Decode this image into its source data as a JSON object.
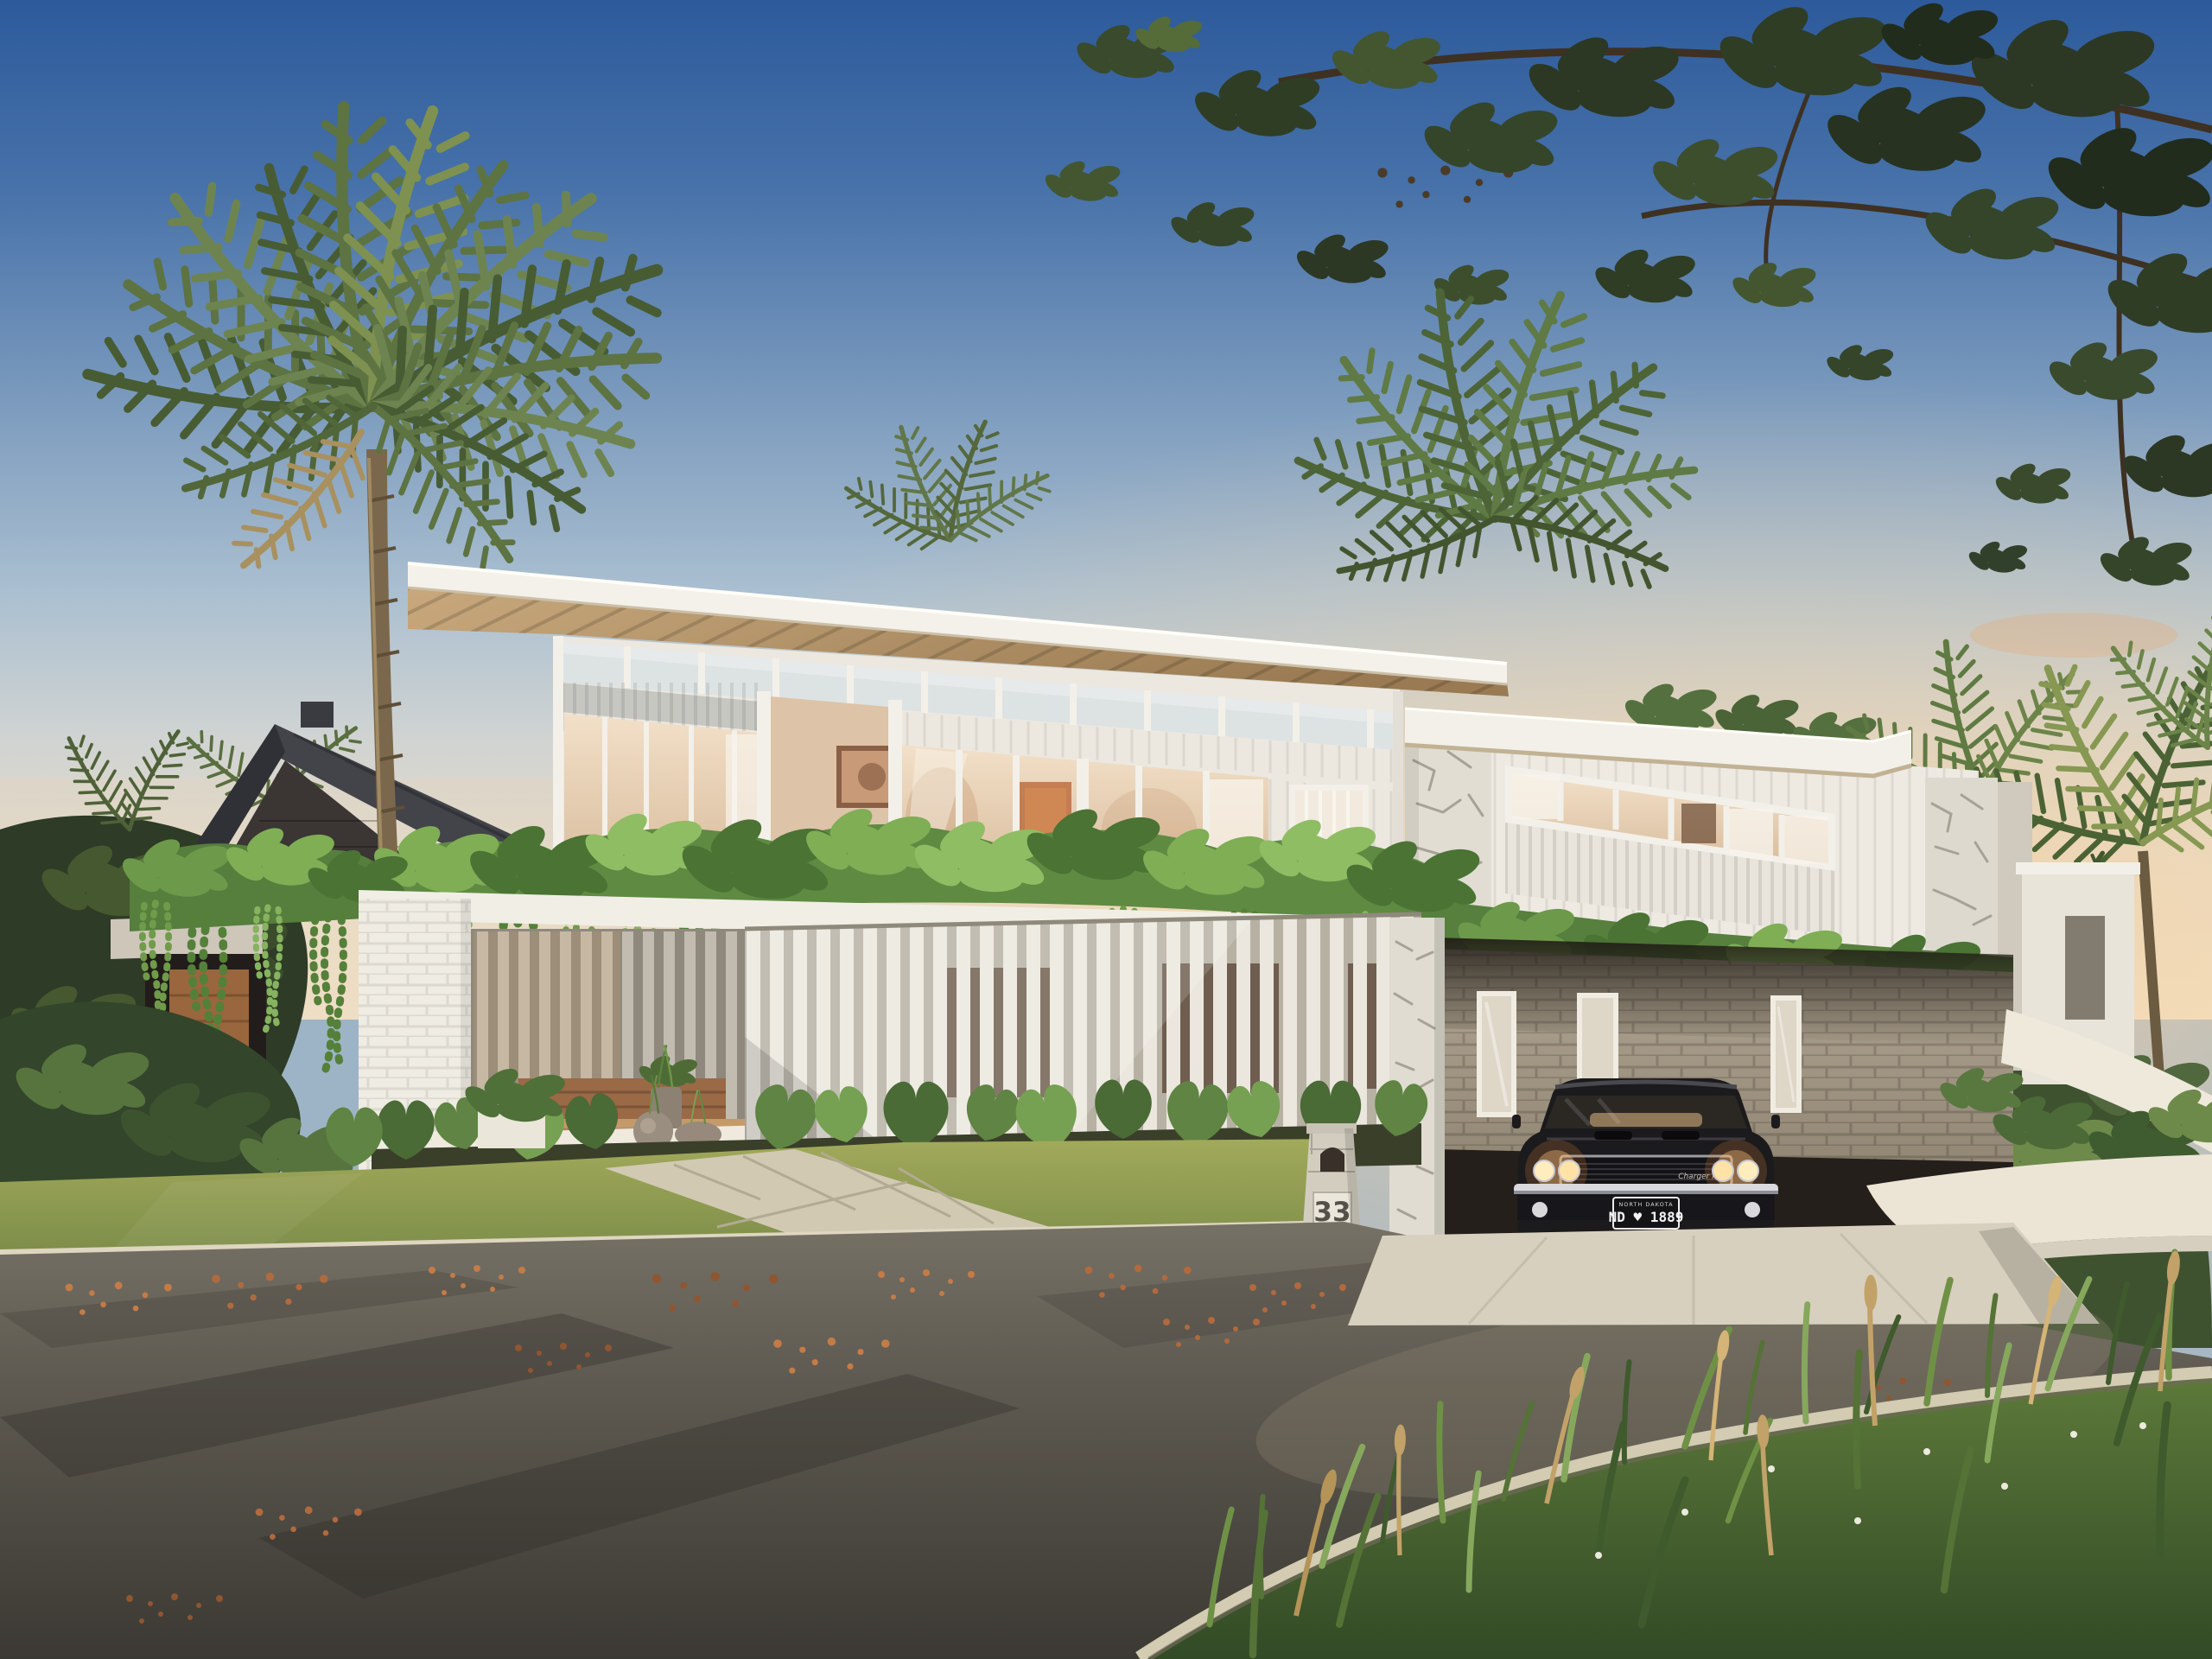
{
  "scene": {
    "type": "architectural_render",
    "time_of_day": "dusk",
    "description": "Photorealistic exterior render of a modern two-storey coastal home: timber-lined skillion roof, white vertical-batten cladding, glass upper storey, stone-clad piers, cascading vines over the balcony edge, brick carport with a black classic muscle car (headlights on), front lawn with stone path, letterbox 33, asphalt street with fallen leaves, palms and an overhanging tree at dusk",
    "letterbox": {
      "number": "33"
    },
    "car": {
      "description": "black classic muscle car with headlights on, parked in carport",
      "plate_header": "NORTH DAKOTA",
      "plate": "ND ♥ 1889",
      "badge": "Charger R/T"
    }
  },
  "colors": {
    "sky_top": "#2d5a9b",
    "sky_mid": "#7d9cbe",
    "sky_pale": "#cfd3d2",
    "horizon_warm": "#f2e2c8",
    "sunset_glow": "#f6d2a0",
    "roof_timber": "#bd9c6f",
    "fascia_white": "#f4f1ea",
    "cladding_white": "#ece8e0",
    "glass_warm_interior": "#e8d2b8",
    "glass_sky_reflection": "#dde3e3",
    "vine_light": "#86b35f",
    "vine_mid": "#5f8a42",
    "vine_dark": "#4a7334",
    "stone_white": "#e0dcd1",
    "brick_taupe": "#a89d8c",
    "brick_terracotta": "#9a6946",
    "brick_white": "#efece3",
    "deck_timber": "#c59a6b",
    "lawn_green": "#8ba04f",
    "foliage_dark": "#2c3823",
    "palm_green": "#5d7342",
    "trunk_brown": "#7b684c",
    "road_asphalt": "#57534b",
    "curb_concrete": "#d6cebb",
    "driveway_concrete": "#d8d0bf",
    "car_black": "#1b1a1c",
    "chrome": "#d9d9de",
    "headlight_glow": "#ffbe7b",
    "fallen_leaf": "#bf7a45",
    "neighbor_roof": "#43444a",
    "neighbor_brick": "#3b3534"
  }
}
